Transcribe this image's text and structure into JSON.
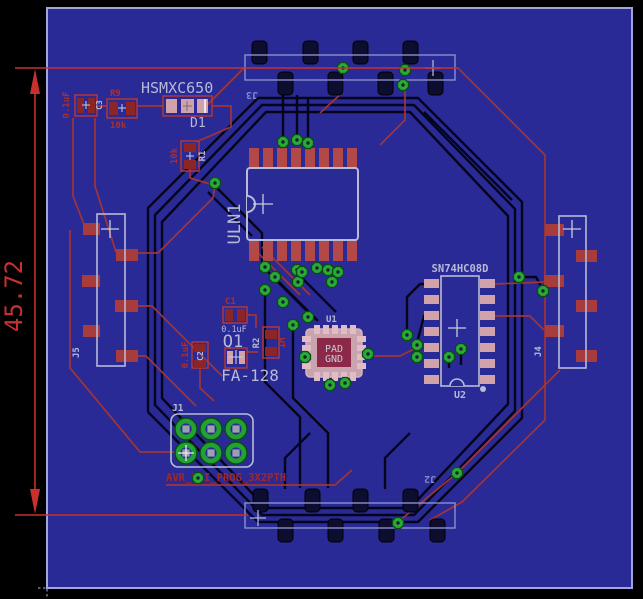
{
  "view": {
    "type": "pcb-board-layout-canvas"
  },
  "dimension": {
    "value": "45.72"
  },
  "colors": {
    "background": "#000000",
    "board": "#2a2a97",
    "board_edge": "#a0a6da",
    "top_copper": "#a23434",
    "bottom_copper": "#04041a",
    "dimension_red": "#c83030",
    "via_green": "#28aa36",
    "pad_pink": "#d2a2aa",
    "pad_red": "#a83c3c",
    "center_pad_maroon": "#8c2848",
    "silkscreen_top": "#b6bad6",
    "silkscreen_bottom": "#8088c8"
  },
  "components": {
    "C3": {
      "name": "C3",
      "value": "0.1uF"
    },
    "R9": {
      "name": "R9",
      "value": "10k"
    },
    "D1": {
      "name": "D1",
      "value": "HSMXC650"
    },
    "R1": {
      "name": "R1",
      "value": "10k"
    },
    "ULN1": {
      "name": "ULN1"
    },
    "C1": {
      "name": "C1",
      "value": "0.1uF"
    },
    "C2": {
      "name": "C2",
      "value": "0.1uF"
    },
    "Q1": {
      "name": "Q1",
      "value": "FA-128"
    },
    "R2": {
      "name": "R2",
      "value": "1M"
    },
    "U1": {
      "name": "U1",
      "pad_line1": "PAD",
      "pad_line2": "GND"
    },
    "U2": {
      "name": "U2",
      "value": "SN74HC08D"
    },
    "J1": {
      "name": "J1",
      "value": "AVR_SPI_PROG_3X2PTH"
    },
    "J2": {
      "name": "J2"
    },
    "J3": {
      "name": "J3"
    },
    "J4": {
      "name": "J4"
    },
    "J5": {
      "name": "J5"
    }
  }
}
